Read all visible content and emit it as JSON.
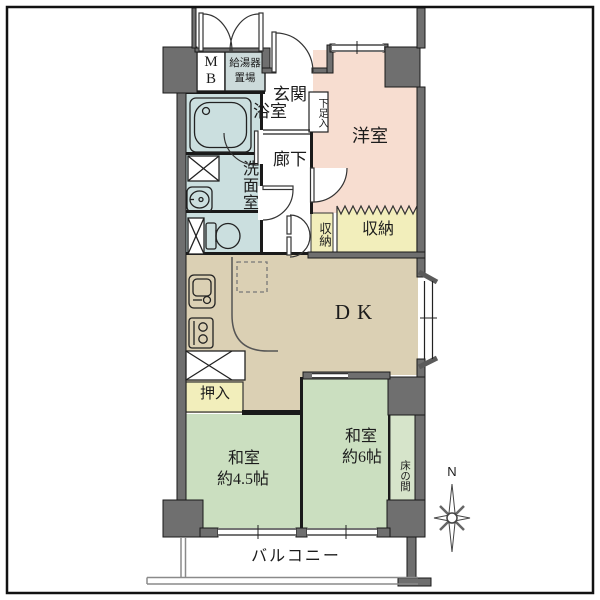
{
  "labels": {
    "meter_box_m": "M",
    "meter_box_b": "B",
    "water_heater": "給湯器\n置場",
    "entrance": "玄関",
    "shoe_cabinet": "下足入",
    "bathroom": "浴室",
    "washroom": "洗面室",
    "hallway": "廊下",
    "western_room": "洋室",
    "storage_small": "収納",
    "storage_large": "収納",
    "dining_kitchen": "DK",
    "oshiire_closet": "押入",
    "japanese_room_45": "和室",
    "japanese_room_45_size": "約4.5帖",
    "japanese_room_6": "和室",
    "japanese_room_6_size": "約6帖",
    "tokonoma": "床の間",
    "balcony": "バルコニー",
    "compass_north": "N"
  },
  "colors": {
    "wall": "#6f6f6f",
    "water_blue": "#cbdfdf",
    "heater_gray": "#ccdada",
    "pink": "#f7ddd0",
    "yellow": "#f2eebb",
    "tan": "#dbd0b4",
    "green": "#cbdfc0",
    "tokonoma_green": "#d6e4ca",
    "line": "#1a1a1a"
  }
}
